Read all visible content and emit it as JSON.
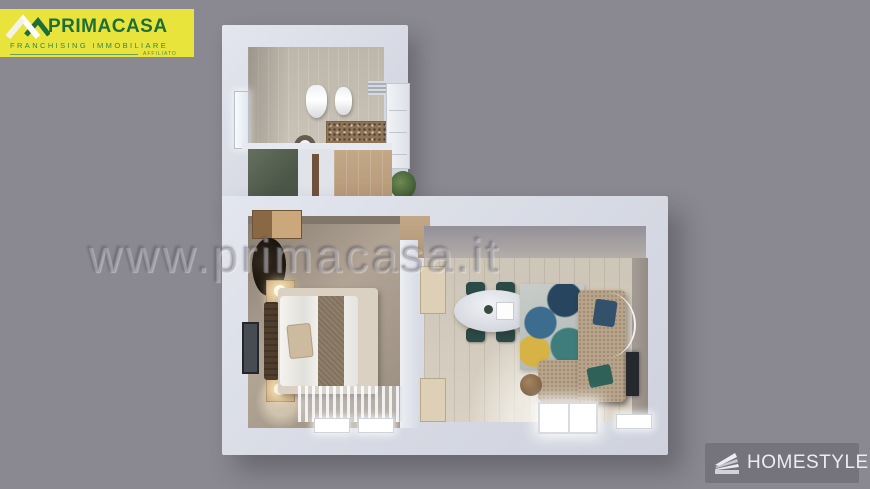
{
  "canvas": {
    "background": "#8A8890"
  },
  "watermark": {
    "text": "www.primacasa.it"
  },
  "branding": {
    "primacasa": {
      "name": "PRIMACASA",
      "tagline": "FRANCHISING IMMOBILIARE",
      "affiliate": "AFFILIATO",
      "colors": {
        "background": "#E9E43C",
        "green_dark": "#1D6E38",
        "green_mid": "#2F8746"
      }
    },
    "homestyler": {
      "label": "HOMESTYLER",
      "colors": {
        "background": "#75737B",
        "text": "#EDECF0"
      }
    }
  }
}
